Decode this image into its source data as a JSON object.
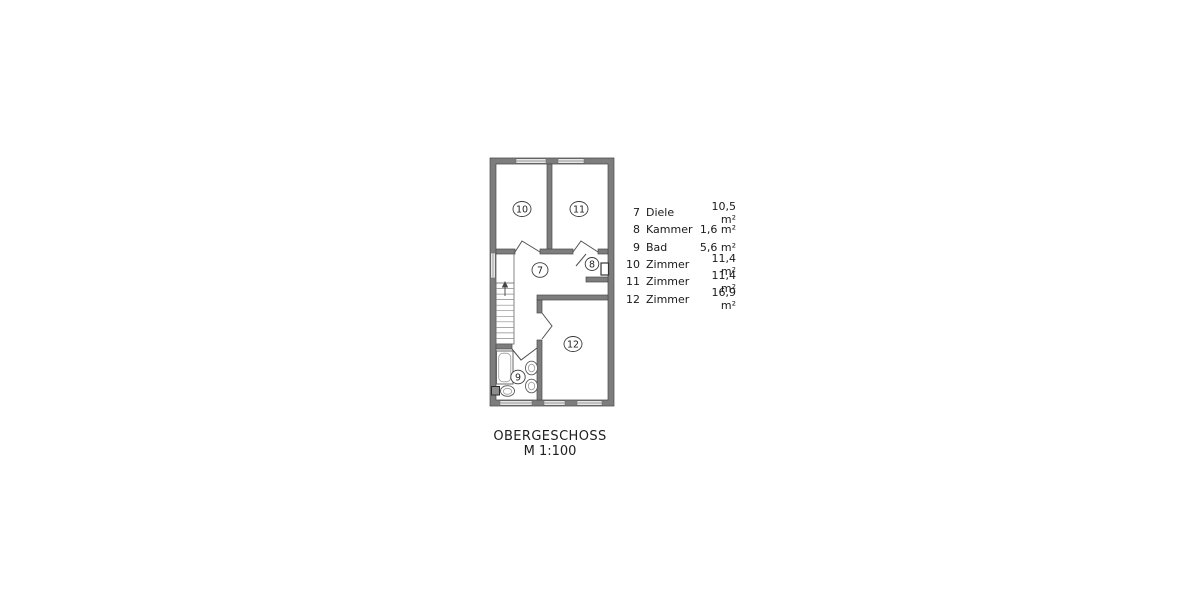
{
  "page": {
    "background": "#ffffff",
    "type_label": "floor-plan-drawing"
  },
  "plan": {
    "colors": {
      "wall": "#7d7d7d",
      "wall_outline": "#4a4a4a",
      "window_fill": "#e6e6e6",
      "line": "#555555",
      "background": "#ffffff"
    },
    "rooms": [
      {
        "number": "7",
        "name": "Diele"
      },
      {
        "number": "8",
        "name": "Kammer"
      },
      {
        "number": "9",
        "name": "Bad"
      },
      {
        "number": "10",
        "name": "Zimmer"
      },
      {
        "number": "11",
        "name": "Zimmer"
      },
      {
        "number": "12",
        "name": "Zimmer"
      }
    ]
  },
  "legend": {
    "rows": [
      {
        "no": "7",
        "name": "Diele",
        "area": "10,5 m²"
      },
      {
        "no": "8",
        "name": "Kammer",
        "area": "1,6 m²"
      },
      {
        "no": "9",
        "name": "Bad",
        "area": "5,6 m²"
      },
      {
        "no": "10",
        "name": "Zimmer",
        "area": "11,4 m²"
      },
      {
        "no": "11",
        "name": "Zimmer",
        "area": "11,4 m²"
      },
      {
        "no": "12",
        "name": "Zimmer",
        "area": "16,9 m²"
      }
    ]
  },
  "title": {
    "line1": "OBERGESCHOSS",
    "line2": "M 1:100"
  }
}
